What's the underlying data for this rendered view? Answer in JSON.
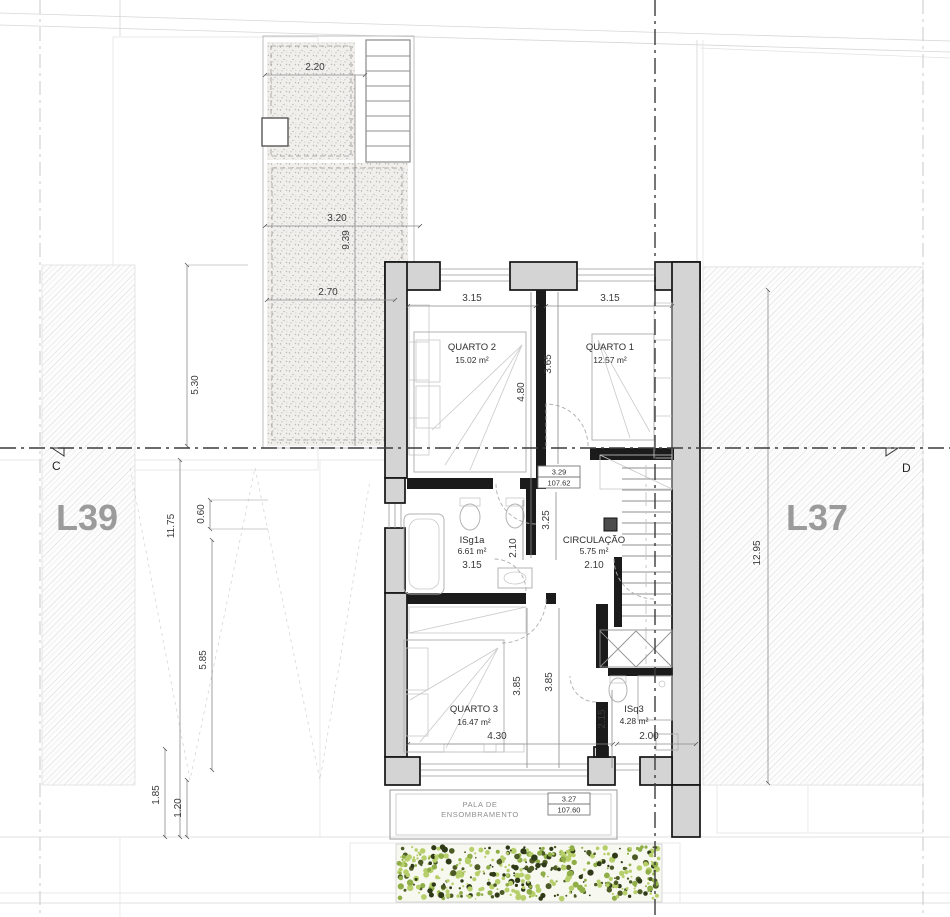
{
  "lots": {
    "left": "L39",
    "right": "L37"
  },
  "section_markers": {
    "left": "C",
    "right": "D"
  },
  "rooms": {
    "quarto2": {
      "name": "QUARTO 2",
      "area": "15.02 m²"
    },
    "quarto1": {
      "name": "QUARTO 1",
      "area": "12.57 m²"
    },
    "quarto3": {
      "name": "QUARTO 3",
      "area": "16.47 m²"
    },
    "circulacao": {
      "name": "CIRCULAÇÃO",
      "area": "5.75 m²"
    },
    "isg1a": {
      "name": "ISg1a",
      "area": "6.61 m²"
    },
    "isq3": {
      "name": "ISq3",
      "area": "4.28 m²"
    }
  },
  "levels": {
    "upper": {
      "value": "3.29",
      "elevation": "107.62"
    },
    "lower": {
      "value": "3.27",
      "elevation": "107.60"
    }
  },
  "shading": {
    "line1": "PALA DE",
    "line2": "ENSOMBRAMENTO"
  },
  "dims": {
    "terrace_width_top": "2.20",
    "terrace_width_mid": "3.20",
    "terrace_length": "9.39",
    "terrace_width_low": "2.70",
    "left_upper": "5.30",
    "left_total": "11.75",
    "left_offset": "0.60",
    "left_lower": "5.85",
    "rear_a": "1.85",
    "rear_b": "1.20",
    "right_total": "12.95",
    "quarto2_width": "3.15",
    "quarto1_width": "3.15",
    "quarto2_depth": "4.80",
    "quarto1_depth": "3.65",
    "hall_upper": "3.25",
    "hall_niche": "2.10",
    "isg1a_width": "3.15",
    "circulacao_width": "2.10",
    "quarto3_depth": "3.85",
    "hall_lower": "3.85",
    "quarto3_width": "4.30",
    "isq3_depth": "2.15",
    "isq3_width": "2.00"
  },
  "colors": {
    "wall_fill": "#d4d4d4",
    "wall_line": "#141414",
    "hatch": "#d9d9d9",
    "dim_text": "#3a3a3a",
    "lot_label": "#9b9b9b",
    "hedge_light": "#b7cf6b",
    "hedge_mid": "#8fae47",
    "hedge_dark": "#4c5a25",
    "hedge_shadow": "#2e3a17"
  }
}
